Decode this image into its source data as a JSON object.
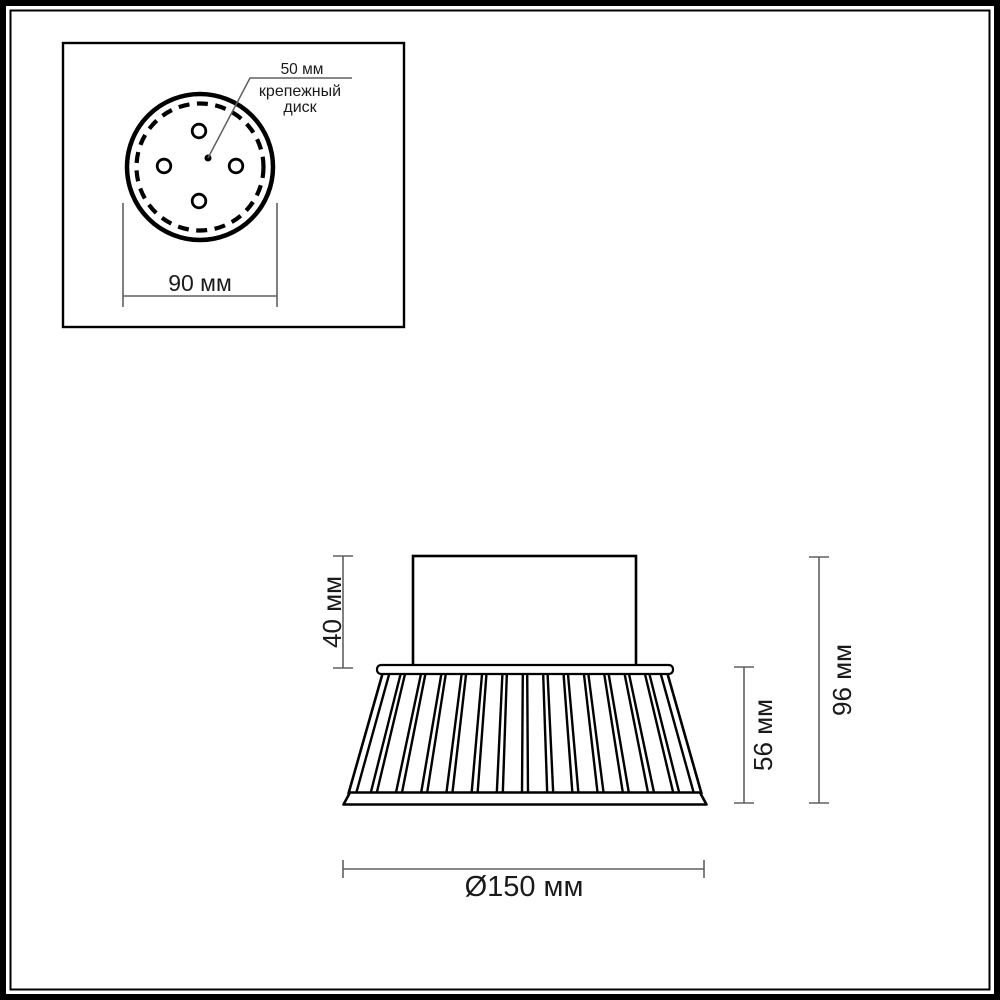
{
  "colors": {
    "drawing_line": "#000000",
    "dimension_line": "#606060",
    "text": "#1a1a1a",
    "background": "#ffffff"
  },
  "inset_top_view": {
    "disk_diameter_label": "50 мм",
    "caption_line1": "крепежный",
    "caption_line2": "диск",
    "width_dimension": "90 мм"
  },
  "side_view": {
    "mount_height_dimension": "40 мм",
    "shade_height_dimension": "56 мм",
    "total_height_dimension": "96 мм",
    "base_diameter_dimension": "Ø150 мм"
  }
}
